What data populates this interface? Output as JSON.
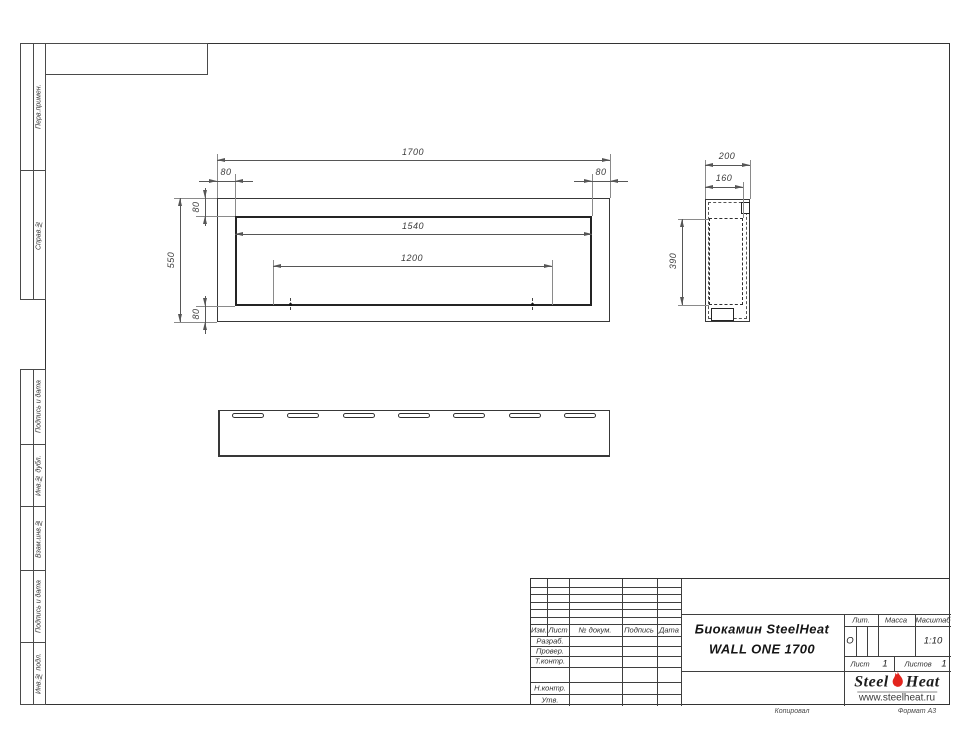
{
  "sheet": {
    "copy_note": "Копировал",
    "format_note": "Формат А3"
  },
  "margin_labels": {
    "group1": [
      {
        "label": "Перв.примен."
      },
      {
        "label": "Справ.№"
      }
    ],
    "group2": [
      {
        "label": "Подпись и дата"
      },
      {
        "label": "Инв.№ дубл."
      },
      {
        "label": "Взам.инв.№"
      },
      {
        "label": "Подпись и дата"
      },
      {
        "label": "Инв.№ подл."
      }
    ]
  },
  "views": {
    "front": {
      "dims": {
        "total_width": "1700",
        "left_border": "80",
        "right_border": "80",
        "top_border": "80",
        "bottom_border": "80",
        "total_height": "550",
        "opening_width": "1540",
        "mount_spacing": "1200"
      }
    },
    "side": {
      "dims": {
        "total_depth": "200",
        "inner_depth": "160",
        "inner_height": "390"
      }
    }
  },
  "title_block": {
    "revision_header": [
      "Изм.",
      "Лист",
      "№ докум.",
      "Подпись",
      "Дата"
    ],
    "role_rows": [
      "Разраб.",
      "Провер.",
      "Т.контр.",
      "Н.контр.",
      "Утв."
    ],
    "title_line1": "Биокамин SteelHeat",
    "title_line2": "WALL ONE 1700",
    "lit_label": "Лит.",
    "lit_value": "О",
    "mass_label": "Масса",
    "scale_label": "Масштаб",
    "scale_value": "1:10",
    "sheet_label": "Лист",
    "sheet_value": "1",
    "sheets_label": "Листов",
    "sheets_value": "1",
    "logo": {
      "word1": "Steel",
      "word2": "Heat",
      "site": "www.steelheat.ru",
      "flame_color": "#e3241d"
    }
  }
}
